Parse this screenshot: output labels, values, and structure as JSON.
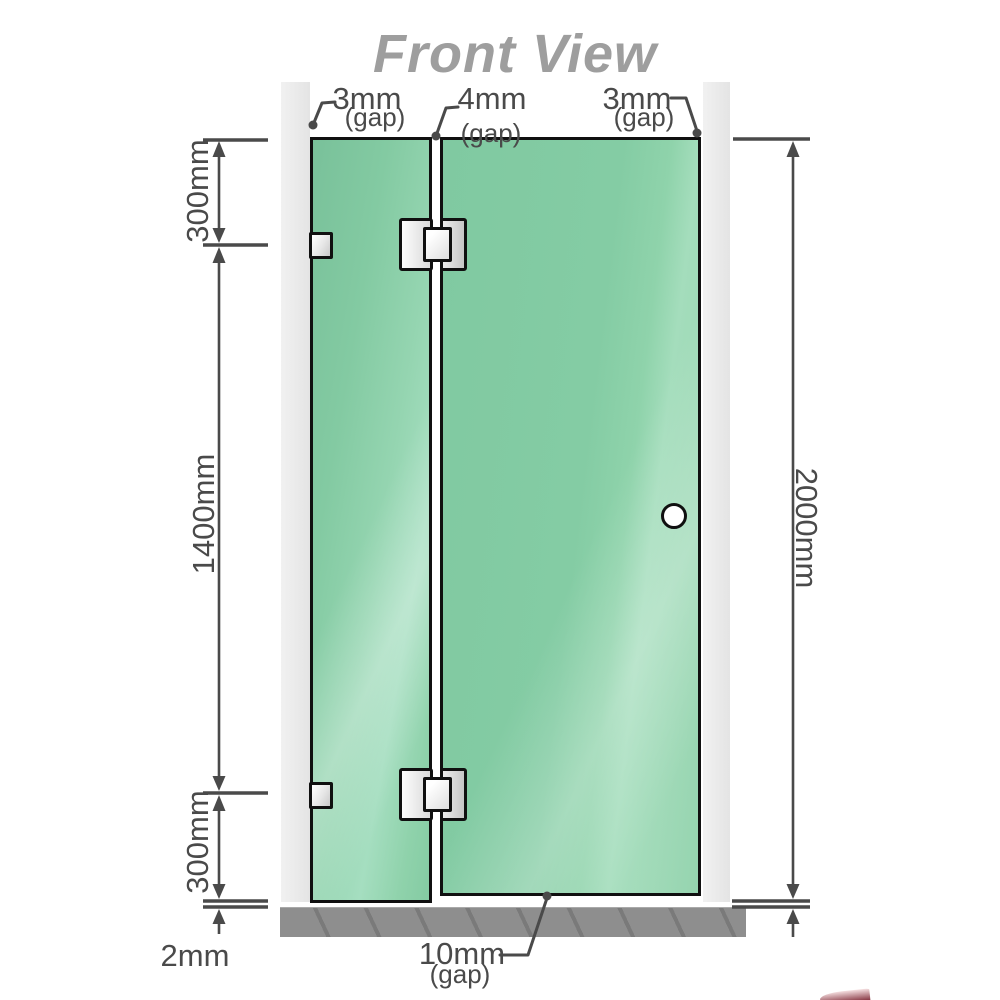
{
  "title": "Front View",
  "annotations": {
    "top_left_gap": {
      "value": "3mm",
      "suffix": "(gap)"
    },
    "top_middle_gap": {
      "value": "4mm",
      "suffix": "(gap)"
    },
    "top_right_gap": {
      "value": "3mm",
      "suffix": "(gap)"
    },
    "bottom_gap": {
      "value": "10mm",
      "suffix": "(gap)"
    },
    "floor_gap": "2mm"
  },
  "dimensions": {
    "left_top": "300mm",
    "left_middle": "1400mm",
    "left_bottom": "300mm",
    "right_total": "2000mm"
  },
  "colors": {
    "glass_green": "#85cca5",
    "glass_highlight": "#a6dec0",
    "wall_gray": "#ebebeb",
    "floor_gray": "#8e8e8e",
    "dimension_gray": "#4a4a4a",
    "title_gray": "#9e9e9e",
    "outline_black": "#101010",
    "hardware_white": "#f4f4f4",
    "logo_red": "#7a2330"
  }
}
